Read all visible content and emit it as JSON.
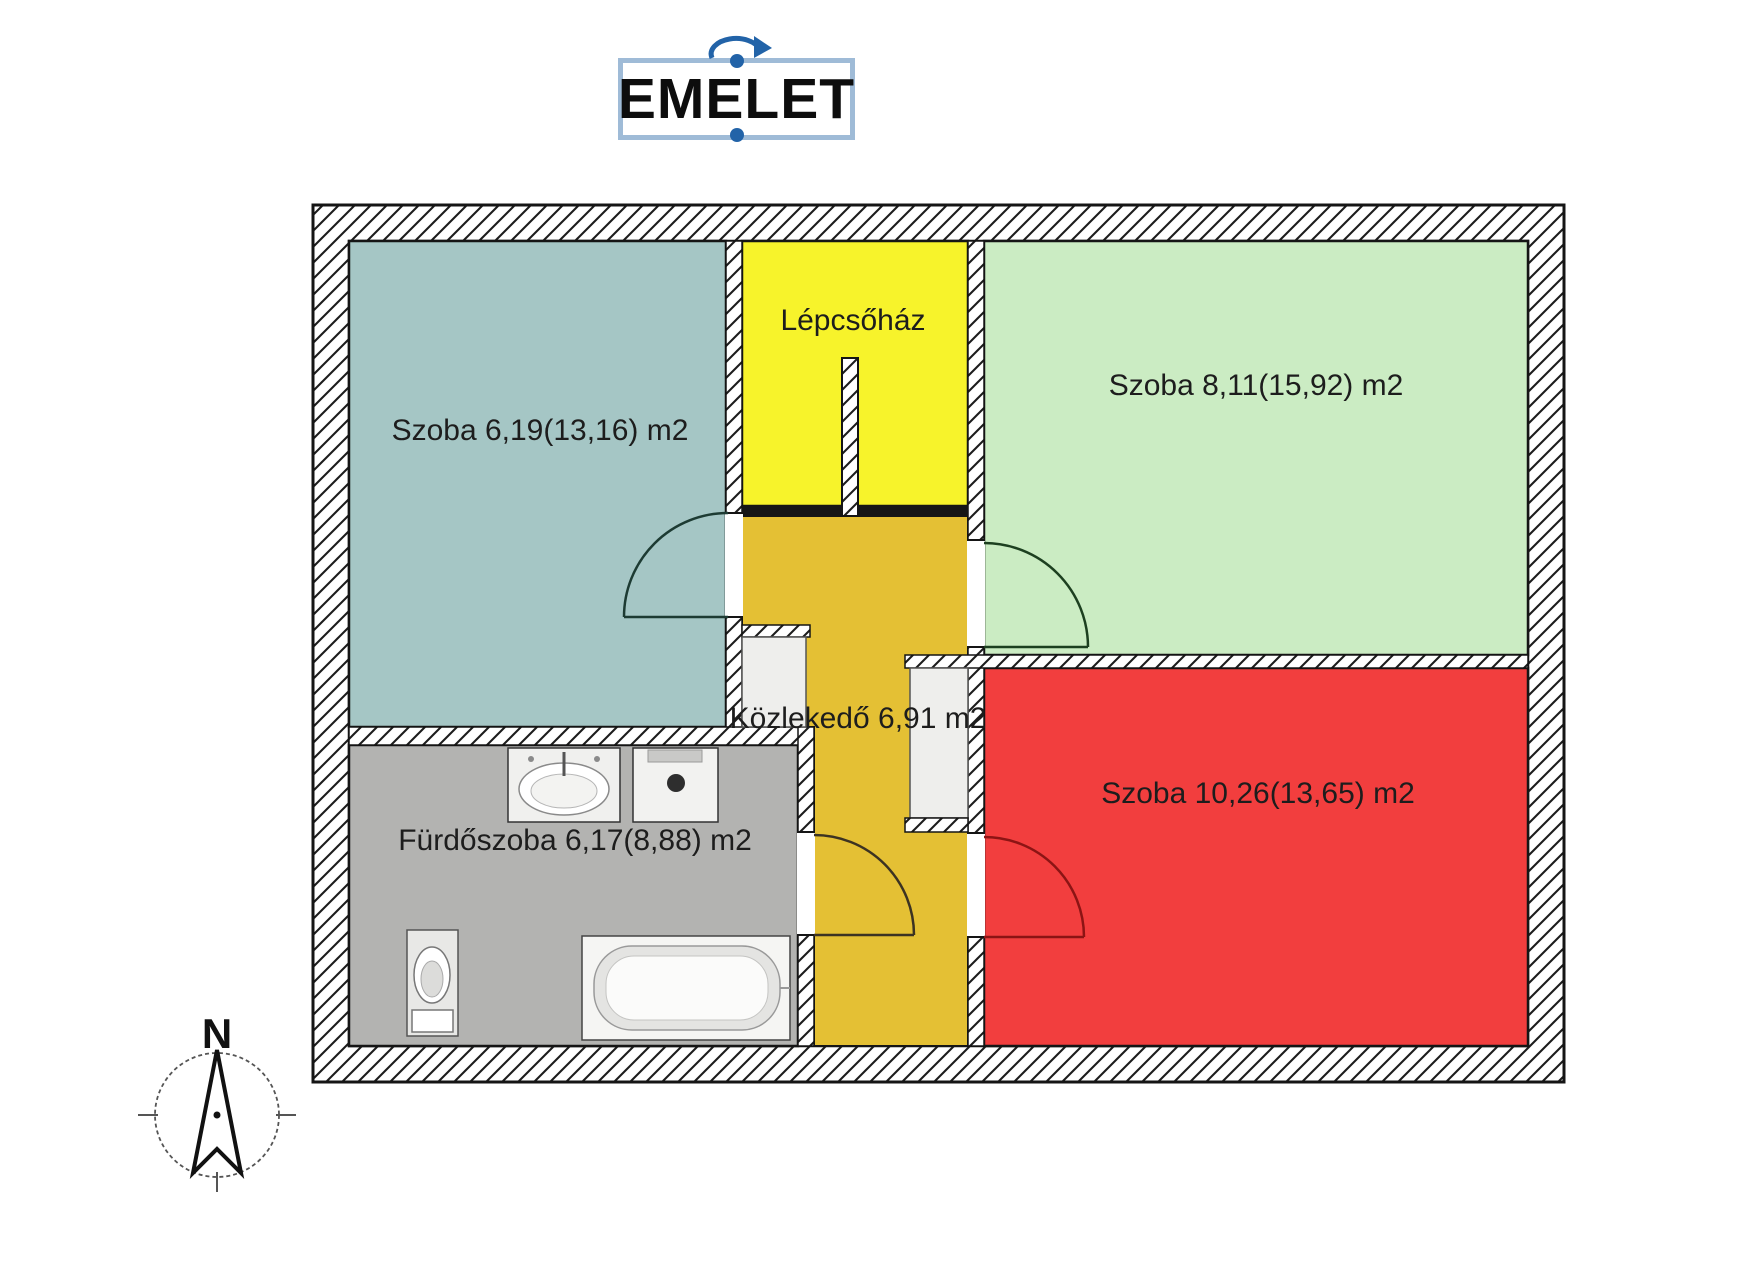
{
  "title": {
    "text": "EMELET"
  },
  "compass": {
    "north_label": "N"
  },
  "rooms": [
    {
      "id": "szoba-1",
      "label": "Szoba 6,19(13,16) m2",
      "color": "#a5c6c5"
    },
    {
      "id": "lepcsohaz",
      "label": "Lépcsőház",
      "color": "#f7f32b"
    },
    {
      "id": "szoba-2",
      "label": "Szoba 8,11(15,92) m2",
      "color": "#cbecc3"
    },
    {
      "id": "kozlekedo",
      "label": "Közlekedő 6,91 m2",
      "color": "#e4c034"
    },
    {
      "id": "furdoszoba",
      "label": "Fürdőszoba 6,17(8,88) m2",
      "color": "#b3b3b1"
    },
    {
      "id": "szoba-3",
      "label": "Szoba 10,26(13,65) m2",
      "color": "#f23e3e"
    }
  ],
  "doors": [
    {
      "into": "szoba-1",
      "color": "#1d3b33"
    },
    {
      "into": "szoba-2",
      "color": "#1d4020"
    },
    {
      "into": "kozlekedo",
      "color": "#3c3322"
    },
    {
      "into": "szoba-3",
      "color": "#8c1414"
    }
  ],
  "fixtures": [
    "sink",
    "washing-machine",
    "toilet",
    "bathtub"
  ],
  "colors": {
    "wall_outline": "#151515",
    "selection_blue": "#2263a8",
    "title_border": "#9fbbd7",
    "niche_fill": "#eeeeec"
  }
}
